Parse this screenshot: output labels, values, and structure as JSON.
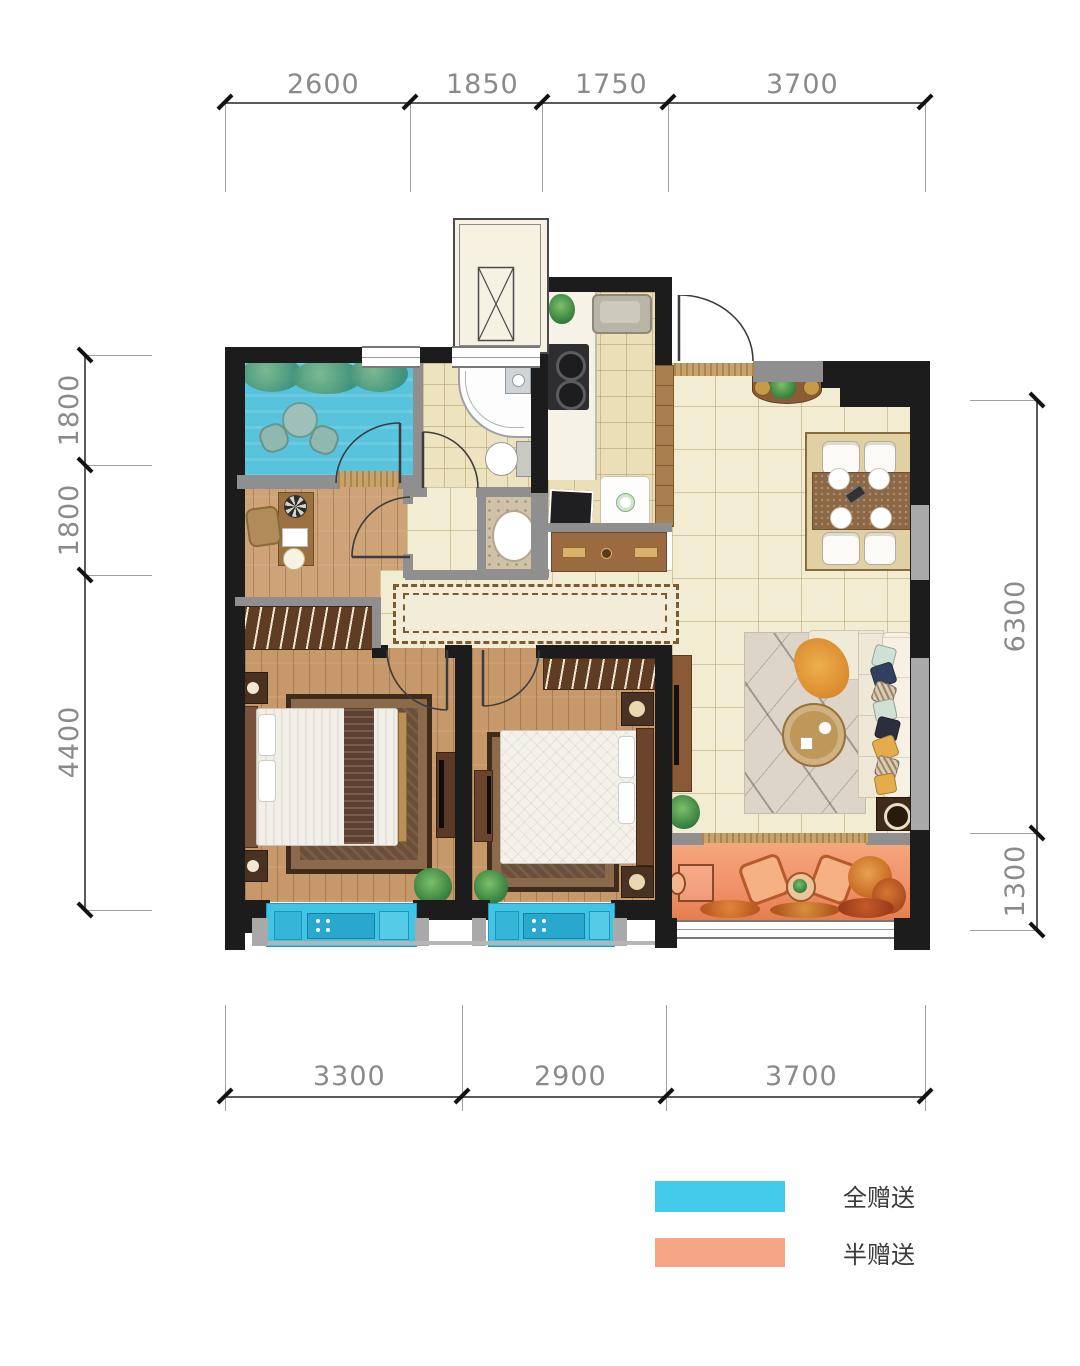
{
  "dimensions": {
    "top": {
      "labels": [
        "2600",
        "1850",
        "1750",
        "3700"
      ]
    },
    "left": {
      "labels": [
        "1800",
        "1800",
        "4400"
      ]
    },
    "right": {
      "labels": [
        "6300",
        "1300"
      ]
    },
    "bottom": {
      "labels": [
        "3300",
        "2900",
        "3700"
      ]
    }
  },
  "legend": {
    "items": [
      {
        "label": "全赠送",
        "color": "#43c9e9"
      },
      {
        "label": "半赠送",
        "color": "#f6a687"
      }
    ]
  },
  "colors": {
    "gift_full": "#43c9e9",
    "gift_half": "#f6a687",
    "balcony_cyan": "#58c3dd",
    "bay_window_cyan": "#3fc4e6",
    "balcony_orange": "#f09068",
    "wall": "#1c1c1c",
    "wood_floor": "#c6986a",
    "tile_floor": "#f2ecd3"
  }
}
